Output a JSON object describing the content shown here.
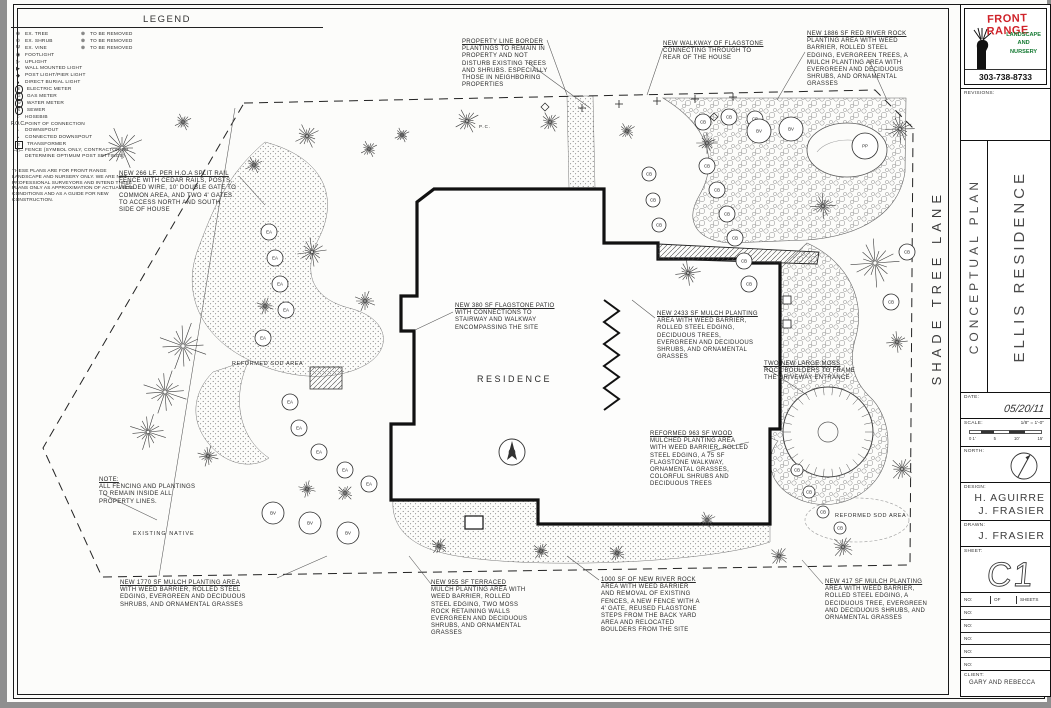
{
  "page": {
    "ink": "#1a1a1a",
    "desk_bg": "#8f8f8f",
    "sheet_bg": "#fcfcfa"
  },
  "legend": {
    "title": "LEGEND",
    "items": [
      {
        "icon": "⊕",
        "label": "EX. TREE",
        "removed_icon": "⊗",
        "removed_label": "TO BE REMOVED"
      },
      {
        "icon": "⊙",
        "label": "EX. SHRUB",
        "removed_icon": "⊗",
        "removed_label": "TO BE REMOVED"
      },
      {
        "icon": "Ψ",
        "label": "EX. VINE",
        "removed_icon": "⊗",
        "removed_label": "TO BE REMOVED"
      },
      {
        "icon": "◉",
        "label": "FOOTLIGHT"
      },
      {
        "icon": "▷",
        "label": "UPLIGHT"
      },
      {
        "icon": "▶",
        "label": "WALL MOUNTED LIGHT"
      },
      {
        "icon": "◆",
        "label": "POST LIGHT/PIER LIGHT"
      },
      {
        "icon": "●",
        "label": "DIRECT BURIAL LIGHT"
      },
      {
        "icon": "E",
        "circled": true,
        "label": "ELECTRIC METER"
      },
      {
        "icon": "G",
        "circled": true,
        "label": "GAS METER"
      },
      {
        "icon": "W",
        "circled": true,
        "label": "WATER METER"
      },
      {
        "icon": "S",
        "circled": true,
        "label": "SEWER"
      },
      {
        "icon": "○",
        "label": "HOSEBIB"
      },
      {
        "icon": "P.O.C.",
        "label": "POINT OF CONNECTION"
      },
      {
        "icon": "▫",
        "label": "DOWNSPOUT"
      },
      {
        "icon": "▪",
        "label": "CONNECTED DOWNSPOUT"
      },
      {
        "icon": "T",
        "boxed": true,
        "label": "TRANSFORMER"
      },
      {
        "icon": "─□─",
        "label": "FENCE (SYMBOL ONLY, CONTRACTOR TO DETERMINE OPTIMUM POST SETTINGS)"
      }
    ]
  },
  "disclaimer": "THESE PLANS ARE FOR FRONT RANGE LANDSCAPE AND NURSERY ONLY. WE ARE NOT PROFESSIONAL SURVEYORS AND INTEND THESE PLANS ONLY AS APPROXIMATION OF ACTUAL SITE CONDITIONS AND AS A GUIDE FOR NEW CONSTRUCTION.",
  "annotations": [
    {
      "name": "callout-property-line-border",
      "x": 455,
      "y": 39,
      "w": 95,
      "text": "PROPERTY LINE BORDER PLANTINGS TO REMAIN IN PROPERTY AND NOT DISTURB EXISTING TREES AND SHRUBS. ESPECIALLY THOSE IN NEIGHBORING PROPERTIES"
    },
    {
      "name": "callout-flagstone-walkway",
      "x": 656,
      "y": 41,
      "w": 102,
      "text": "NEW WALKWAY OF FLAGSTONE CONNECTING THROUGH TO REAR OF THE HOUSE"
    },
    {
      "name": "callout-red-river-rock",
      "x": 800,
      "y": 31,
      "w": 104,
      "text": "NEW 1886 SF RED RIVER ROCK PLANTING AREA WITH WEED BARRIER, ROLLED STEEL EDGING, EVERGREEN TREES, A MULCH PLANTING AREA WITH EVERGREEN AND DECIDUOUS SHRUBS, AND ORNAMENTAL GRASSES"
    },
    {
      "name": "callout-split-rail-fence",
      "x": 112,
      "y": 171,
      "w": 118,
      "text": "NEW 266 LF. PER H.O.A SPLIT RAIL FENCE WITH CEDAR RAILS, POSTS, WELDED WIRE, 10' DOUBLE GATE TO COMMON AREA, AND TWO 4' GATES TO ACCESS NORTH AND SOUTH SIDE OF HOUSE"
    },
    {
      "name": "callout-flagstone-patio",
      "x": 448,
      "y": 303,
      "w": 106,
      "text": "NEW 380 SF FLAGSTONE PATIO WITH CONNECTIONS TO STAIRWAY AND WALKWAY ENCOMPASSING THE SITE"
    },
    {
      "name": "callout-mulch-2433",
      "x": 650,
      "y": 311,
      "w": 102,
      "text": "NEW 2433 SF MULCH PLANTING AREA WITH WEED BARRIER, ROLLED STEEL EDGING, DECIDUOUS TREES, EVERGREEN AND DECIDUOUS SHRUBS, AND ORNAMENTAL GRASSES"
    },
    {
      "name": "callout-moss-rock-boulders",
      "x": 757,
      "y": 361,
      "w": 92,
      "text": "TWO NEW LARGE MOSS ROCK BOULDERS TO FRAME THE DRIVEWAY ENTRANCE"
    },
    {
      "name": "callout-reformed-wood-mulch",
      "x": 643,
      "y": 431,
      "w": 102,
      "text": "REFORMED 963 SF WOOD MULCHED PLANTING AREA WITH WEED BARRIER, ROLLED STEEL EDGING, A 75 SF FLAGSTONE WALKWAY, ORNAMENTAL GRASSES, COLORFUL SHRUBS AND DECIDUOUS TREES"
    },
    {
      "name": "callout-fencing-note",
      "x": 92,
      "y": 477,
      "w": 112,
      "text": "NOTE:\nALL FENCING AND PLANTINGS\nTO REMAIN INSIDE ALL\nPROPERTY LINES."
    },
    {
      "name": "callout-mulch-1770",
      "x": 113,
      "y": 580,
      "w": 136,
      "text": "NEW 1770 SF MULCH PLANTING AREA WITH WEED BARRIER, ROLLED STEEL EDGING, EVERGREEN AND DECIDUOUS SHRUBS, AND ORNAMENTAL GRASSES"
    },
    {
      "name": "callout-terraced-mulch",
      "x": 424,
      "y": 580,
      "w": 100,
      "text": "NEW 955 SF TERRACED MULCH PLANTING AREA WITH WEED BARRIER, ROLLED STEEL EDGING, TWO MOSS ROCK RETAINING WALLS EVERGREEN AND DECIDUOUS SHRUBS, AND ORNAMENTAL GRASSES"
    },
    {
      "name": "callout-river-rock-1000",
      "x": 594,
      "y": 577,
      "w": 100,
      "text": "1000 SF OF NEW RIVER ROCK AREA WITH WEED BARRIER AND REMOVAL OF EXISTING FENCES, A NEW FENCE WITH A 4' GATE, REUSED FLAGSTONE STEPS FROM THE BACK YARD AREA AND RELOCATED BOULDERS FROM THE SITE"
    },
    {
      "name": "callout-mulch-417",
      "x": 818,
      "y": 579,
      "w": 106,
      "text": "NEW 417 SF MULCH PLANTING AREA WITH WEED BARRIER, ROLLED STEEL EDGING, A DECIDUOUS TREE, EVERGREEN AND DECIDUOUS SHRUBS, AND ORNAMENTAL GRASSES"
    }
  ],
  "plan_labels": [
    {
      "name": "residence-label",
      "text": "RESIDENCE",
      "x": 470,
      "y": 374,
      "size": 9,
      "spacing": 2.5
    },
    {
      "name": "existing-native-label",
      "text": "EXISTING NATIVE",
      "x": 126,
      "y": 531,
      "size": 5.5,
      "spacing": 1
    },
    {
      "name": "reformed-sod-area-label",
      "text": "REFORMED SOD AREA",
      "x": 225,
      "y": 361,
      "size": 5.5,
      "spacing": 0.6
    },
    {
      "name": "reformed-sod-area-label",
      "text": "REFORMED SOD AREA",
      "x": 828,
      "y": 513,
      "size": 5.5,
      "spacing": 0.6
    },
    {
      "name": "poc-label",
      "text": "P.C.",
      "x": 472,
      "y": 124,
      "size": 4.5
    },
    {
      "name": "street-name-label",
      "text": "SHADE TREE LANE",
      "x": 922,
      "y": 190,
      "size": 13,
      "spacing": 5,
      "vertical": true
    }
  ],
  "plan": {
    "trees": [
      [
        115,
        148,
        22
      ],
      [
        176,
        122,
        9
      ],
      [
        300,
        136,
        13
      ],
      [
        362,
        149,
        9
      ],
      [
        460,
        121,
        13
      ],
      [
        543,
        122,
        11
      ],
      [
        620,
        131,
        9
      ],
      [
        700,
        143,
        11
      ],
      [
        893,
        129,
        15
      ],
      [
        816,
        206,
        13
      ],
      [
        868,
        263,
        25
      ],
      [
        890,
        342,
        11
      ],
      [
        681,
        273,
        13
      ],
      [
        305,
        252,
        15
      ],
      [
        358,
        301,
        11
      ],
      [
        258,
        306,
        9
      ],
      [
        176,
        346,
        25
      ],
      [
        158,
        392,
        23
      ],
      [
        141,
        432,
        19
      ],
      [
        201,
        456,
        11
      ],
      [
        300,
        489,
        9
      ],
      [
        338,
        493,
        9
      ],
      [
        895,
        469,
        13
      ],
      [
        836,
        547,
        12
      ],
      [
        772,
        556,
        10
      ],
      [
        432,
        546,
        9
      ],
      [
        534,
        551,
        9
      ],
      [
        610,
        553,
        9
      ],
      [
        700,
        520,
        9
      ],
      [
        395,
        135,
        8
      ],
      [
        247,
        165,
        9
      ]
    ],
    "plants": [
      [
        696,
        122,
        8,
        "CB"
      ],
      [
        722,
        117,
        8,
        "CB"
      ],
      [
        748,
        119,
        8,
        "CB"
      ],
      [
        700,
        166,
        8,
        "CB"
      ],
      [
        710,
        190,
        8,
        "CB"
      ],
      [
        720,
        214,
        8,
        "CB"
      ],
      [
        728,
        238,
        8,
        "CB"
      ],
      [
        737,
        261,
        8,
        "CB"
      ],
      [
        742,
        284,
        8,
        "CB"
      ],
      [
        646,
        200,
        7,
        "CB"
      ],
      [
        652,
        225,
        7,
        "CB"
      ],
      [
        642,
        174,
        7,
        "CB"
      ],
      [
        900,
        252,
        8,
        "CB"
      ],
      [
        884,
        302,
        8,
        "CB"
      ],
      [
        790,
        470,
        6,
        "CB"
      ],
      [
        802,
        492,
        6,
        "CB"
      ],
      [
        816,
        512,
        6,
        "CB"
      ],
      [
        833,
        528,
        6,
        "CB"
      ],
      [
        262,
        232,
        8,
        "EA"
      ],
      [
        268,
        258,
        8,
        "EA"
      ],
      [
        273,
        284,
        8,
        "EA"
      ],
      [
        279,
        310,
        8,
        "EA"
      ],
      [
        256,
        338,
        8,
        "EA"
      ],
      [
        283,
        402,
        8,
        "EA"
      ],
      [
        292,
        428,
        8,
        "EA"
      ],
      [
        312,
        452,
        8,
        "EA"
      ],
      [
        338,
        470,
        8,
        "EA"
      ],
      [
        362,
        484,
        8,
        "EA"
      ],
      [
        266,
        513,
        11,
        "BV"
      ],
      [
        303,
        523,
        11,
        "BV"
      ],
      [
        341,
        533,
        11,
        "BV"
      ],
      [
        752,
        131,
        12,
        "BV"
      ],
      [
        784,
        129,
        12,
        "BV"
      ],
      [
        858,
        146,
        13,
        "PP"
      ]
    ],
    "leaders": [
      [
        520,
        62,
        583,
        108
      ],
      [
        656,
        48,
        640,
        95
      ],
      [
        798,
        52,
        770,
        100
      ],
      [
        232,
        176,
        258,
        205
      ],
      [
        446,
        312,
        408,
        330
      ],
      [
        648,
        318,
        625,
        300
      ],
      [
        756,
        366,
        800,
        395
      ],
      [
        700,
        452,
        742,
        442
      ],
      [
        96,
        494,
        150,
        520
      ],
      [
        270,
        578,
        320,
        556
      ],
      [
        424,
        584,
        402,
        556
      ],
      [
        592,
        580,
        560,
        556
      ],
      [
        816,
        584,
        795,
        560
      ],
      [
        228,
        108,
        152,
        576
      ],
      [
        540,
        40,
        560,
        95
      ],
      [
        862,
        60,
        880,
        100
      ]
    ]
  },
  "title_block": {
    "logo": {
      "line1": "FRONT RANGE",
      "line2": "LANDSCAPE",
      "line3": "AND",
      "line4": "NURSERY",
      "phone": "303-738-8733",
      "red": "#cf2229",
      "green": "#157a33"
    },
    "revisions_label": "REVISIONS:",
    "plan_type": "CONCEPTUAL PLAN",
    "project_name": "ELLIS RESIDENCE",
    "date_label": "DATE:",
    "date_value": "05/20/11",
    "scale_label": "SCALE:",
    "scale_value": "1/8\" = 1'-0\"",
    "scale_ticks": [
      "0 1'",
      "5",
      "10'",
      "15'"
    ],
    "north_label": "NORTH:",
    "design_label": "DESIGN:",
    "design_names": [
      "H. AGUIRRE",
      "J. FRASIER"
    ],
    "drawn_label": "DRAWN:",
    "drawn_name": "J. FRASIER",
    "sheet_label": "SHEET:",
    "sheet_value": "C1",
    "table": {
      "col1": "NO:",
      "col2": "OF",
      "col3": "SHEETS",
      "rows": [
        "NO:",
        "NO:",
        "NO:",
        "NO:",
        "NO:"
      ]
    },
    "client_label": "CLIENT:",
    "client_name": "GARY AND REBECCA"
  }
}
